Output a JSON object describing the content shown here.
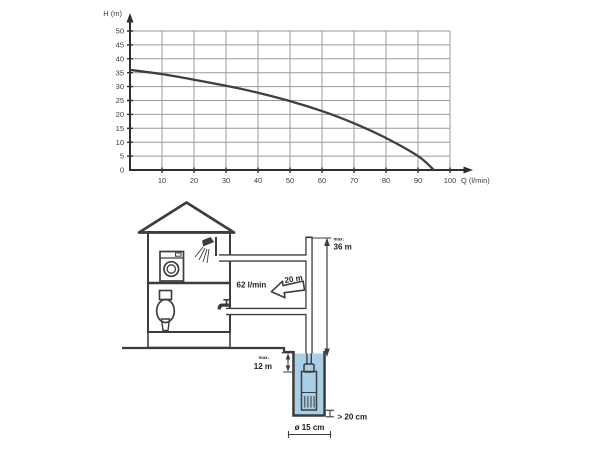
{
  "chart_data": {
    "type": "line",
    "title": "",
    "xlabel": "Q (l/min)",
    "ylabel": "H (m)",
    "xlim": [
      0,
      100
    ],
    "ylim": [
      0,
      50
    ],
    "x_ticks": [
      10,
      20,
      30,
      40,
      50,
      60,
      70,
      80,
      90,
      100
    ],
    "y_ticks": [
      0,
      5,
      10,
      15,
      20,
      25,
      30,
      35,
      40,
      45,
      50
    ],
    "grid": true,
    "legend": "none",
    "series": [
      {
        "name": "pump-head-curve",
        "x": [
          0,
          10,
          20,
          30,
          40,
          50,
          60,
          70,
          80,
          90,
          95
        ],
        "y": [
          36,
          34.5,
          32.5,
          30.3,
          27.8,
          24.8,
          21.2,
          16.8,
          11.5,
          5,
          0
        ]
      }
    ],
    "colors": {
      "curve": "#3f3f3f",
      "grid": "#9a9a9a",
      "axis": "#2e2e2e",
      "text": "#3a3a3a"
    }
  },
  "diagram": {
    "labels": {
      "flow_rate": "62 l/min",
      "pipe_length": "20 m",
      "max_prefix": "max.",
      "max_head": "36 m",
      "max_immersion": "12 m",
      "bottom_clearance": "> 20 cm",
      "well_diameter": "ø 15 cm"
    },
    "colors": {
      "water": "#a9cfe6",
      "pump_body": "#c9dff0",
      "outline": "#3d3d3d",
      "foundation": "#a8a8a8"
    }
  }
}
